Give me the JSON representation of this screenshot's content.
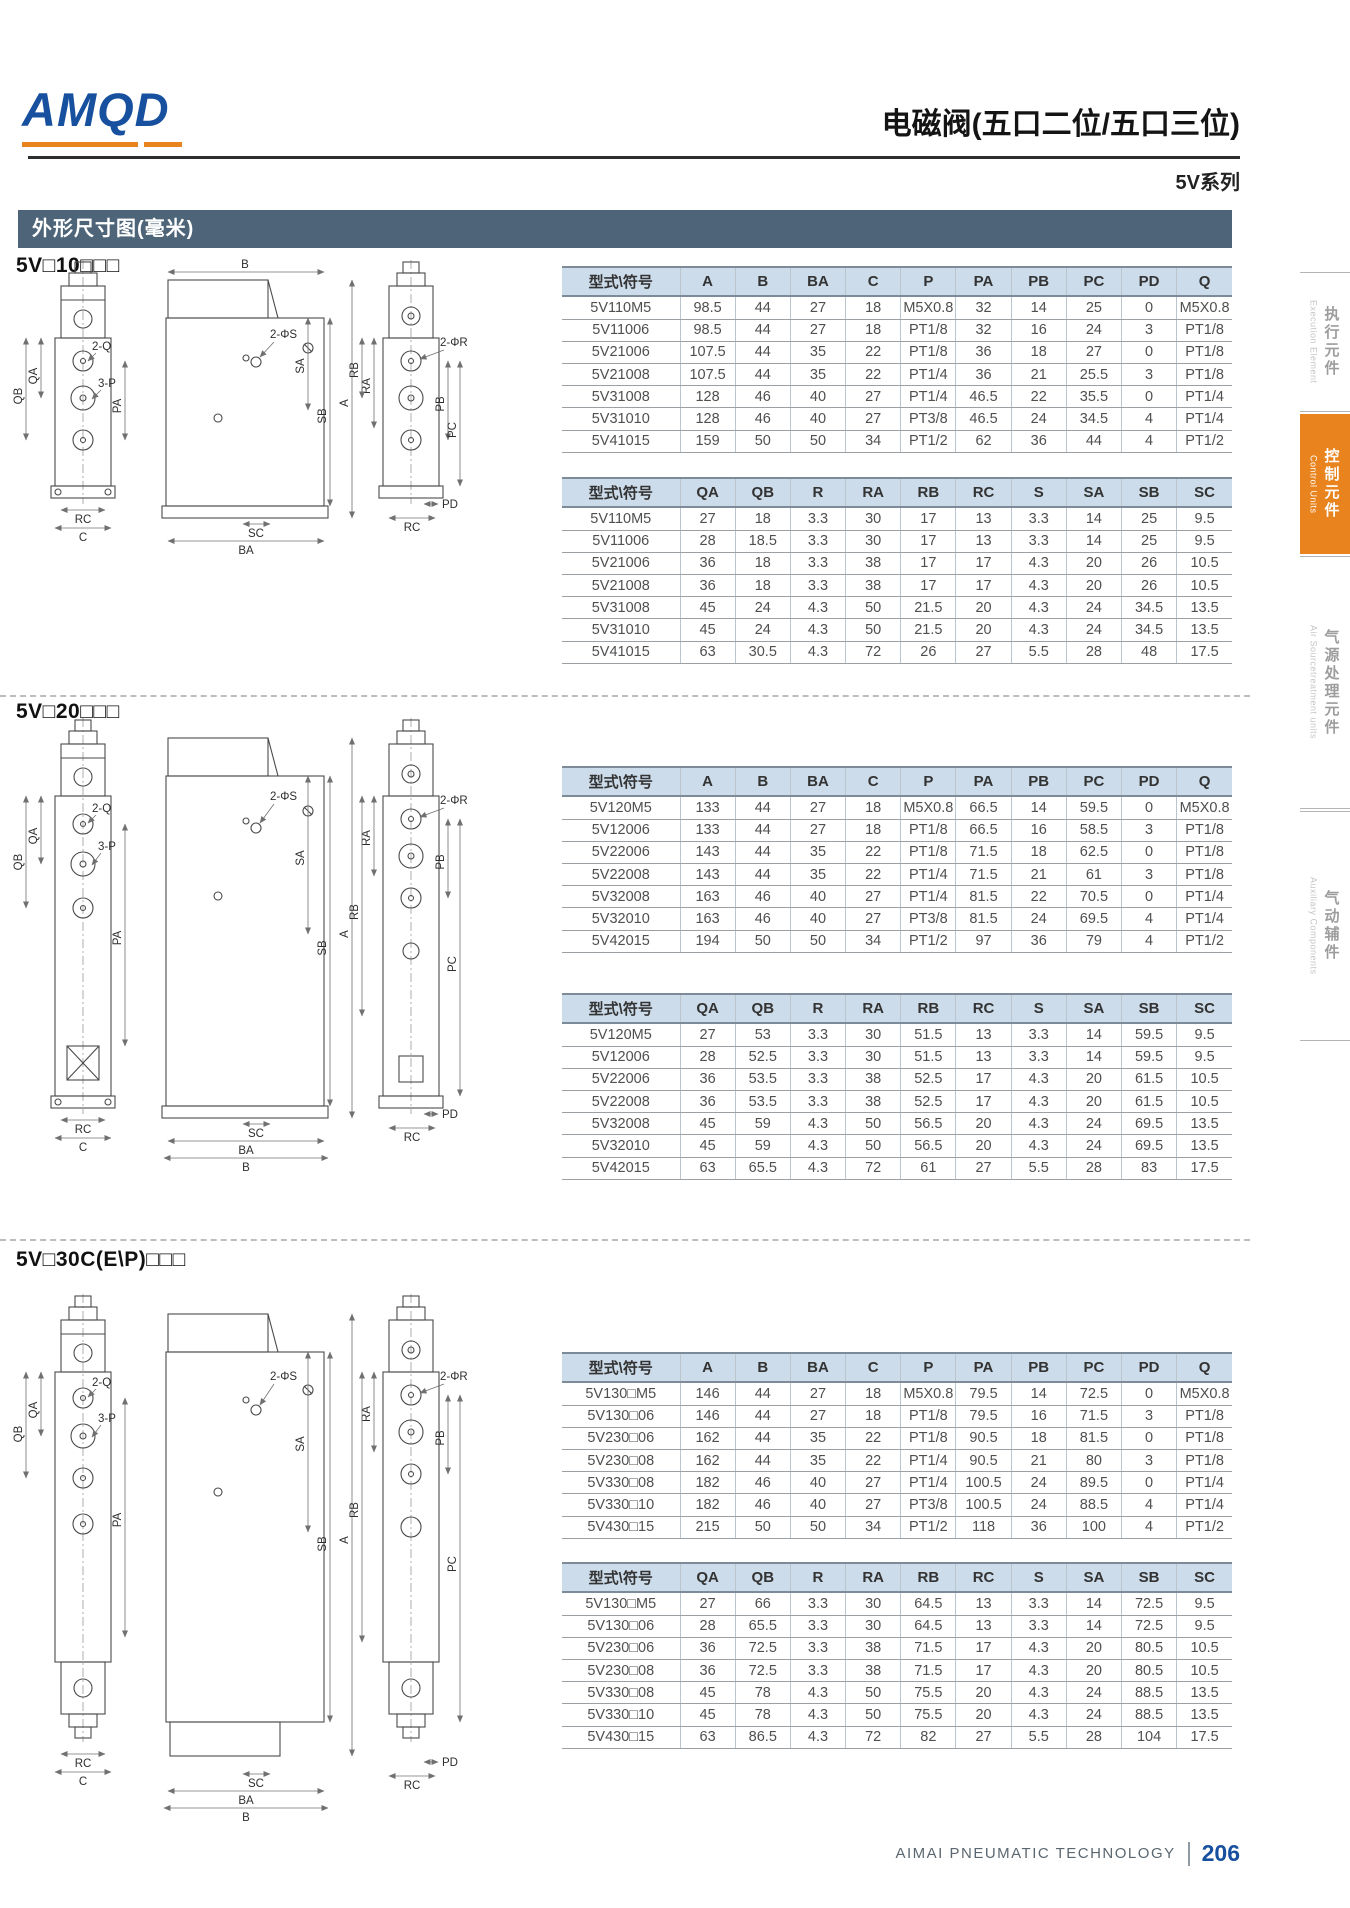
{
  "brand": {
    "logo": "AMQD",
    "title": "电磁阀(五口二位/五口三位)",
    "series": "5V系列"
  },
  "section_bar": "外形尺寸图(毫米)",
  "footer": {
    "company": "AIMAI PNEUMATIC TECHNOLOGY",
    "page": "206"
  },
  "sidebar": [
    {
      "cn": "执行元件",
      "en": "Execution Element"
    },
    {
      "cn": "控制元件",
      "en": "Control Units"
    },
    {
      "cn": "气源处理元件",
      "en": "Air Sourcetreatment units"
    },
    {
      "cn": "气动辅件",
      "en": "Auxiliary Components"
    }
  ],
  "accent_colors": {
    "brand_blue": "#17509e",
    "accent_orange": "#e8831d",
    "bar_slate": "#4e6579",
    "table_head": "#ccdcea"
  },
  "dims": {
    "a": "A",
    "b": "B",
    "ba": "BA",
    "c": "C",
    "q2": "2-Q",
    "p3": "3-P",
    "qa": "QA",
    "qb": "QB",
    "pa": "PA",
    "pb": "PB",
    "pc": "PC",
    "pd": "PD",
    "rc": "RC",
    "r2": "2-ΦR",
    "s2": "2-ΦS",
    "ra": "RA",
    "rb": "RB",
    "sa": "SA",
    "sb": "SB",
    "sc": "SC"
  },
  "table_headers": {
    "t1": [
      "型式\\符号",
      "A",
      "B",
      "BA",
      "C",
      "P",
      "PA",
      "PB",
      "PC",
      "PD",
      "Q"
    ],
    "t2": [
      "型式\\符号",
      "QA",
      "QB",
      "R",
      "RA",
      "RB",
      "RC",
      "S",
      "SA",
      "SB",
      "SC"
    ]
  },
  "sections": [
    {
      "label": "5V□10□□□",
      "main_rows": [
        [
          "5V110M5",
          "98.5",
          "44",
          "27",
          "18",
          "M5X0.8",
          "32",
          "14",
          "25",
          "0",
          "M5X0.8"
        ],
        [
          "5V11006",
          "98.5",
          "44",
          "27",
          "18",
          "PT1/8",
          "32",
          "16",
          "24",
          "3",
          "PT1/8"
        ],
        [
          "5V21006",
          "107.5",
          "44",
          "35",
          "22",
          "PT1/8",
          "36",
          "18",
          "27",
          "0",
          "PT1/8"
        ],
        [
          "5V21008",
          "107.5",
          "44",
          "35",
          "22",
          "PT1/4",
          "36",
          "21",
          "25.5",
          "3",
          "PT1/8"
        ],
        [
          "5V31008",
          "128",
          "46",
          "40",
          "27",
          "PT1/4",
          "46.5",
          "22",
          "35.5",
          "0",
          "PT1/4"
        ],
        [
          "5V31010",
          "128",
          "46",
          "40",
          "27",
          "PT3/8",
          "46.5",
          "24",
          "34.5",
          "4",
          "PT1/4"
        ],
        [
          "5V41015",
          "159",
          "50",
          "50",
          "34",
          "PT1/2",
          "62",
          "36",
          "44",
          "4",
          "PT1/2"
        ]
      ],
      "sub_rows": [
        [
          "5V110M5",
          "27",
          "18",
          "3.3",
          "30",
          "17",
          "13",
          "3.3",
          "14",
          "25",
          "9.5"
        ],
        [
          "5V11006",
          "28",
          "18.5",
          "3.3",
          "30",
          "17",
          "13",
          "3.3",
          "14",
          "25",
          "9.5"
        ],
        [
          "5V21006",
          "36",
          "18",
          "3.3",
          "38",
          "17",
          "17",
          "4.3",
          "20",
          "26",
          "10.5"
        ],
        [
          "5V21008",
          "36",
          "18",
          "3.3",
          "38",
          "17",
          "17",
          "4.3",
          "20",
          "26",
          "10.5"
        ],
        [
          "5V31008",
          "45",
          "24",
          "4.3",
          "50",
          "21.5",
          "20",
          "4.3",
          "24",
          "34.5",
          "13.5"
        ],
        [
          "5V31010",
          "45",
          "24",
          "4.3",
          "50",
          "21.5",
          "20",
          "4.3",
          "24",
          "34.5",
          "13.5"
        ],
        [
          "5V41015",
          "63",
          "30.5",
          "4.3",
          "72",
          "26",
          "27",
          "5.5",
          "28",
          "48",
          "17.5"
        ]
      ]
    },
    {
      "label": "5V□20□□□",
      "main_rows": [
        [
          "5V120M5",
          "133",
          "44",
          "27",
          "18",
          "M5X0.8",
          "66.5",
          "14",
          "59.5",
          "0",
          "M5X0.8"
        ],
        [
          "5V12006",
          "133",
          "44",
          "27",
          "18",
          "PT1/8",
          "66.5",
          "16",
          "58.5",
          "3",
          "PT1/8"
        ],
        [
          "5V22006",
          "143",
          "44",
          "35",
          "22",
          "PT1/8",
          "71.5",
          "18",
          "62.5",
          "0",
          "PT1/8"
        ],
        [
          "5V22008",
          "143",
          "44",
          "35",
          "22",
          "PT1/4",
          "71.5",
          "21",
          "61",
          "3",
          "PT1/8"
        ],
        [
          "5V32008",
          "163",
          "46",
          "40",
          "27",
          "PT1/4",
          "81.5",
          "22",
          "70.5",
          "0",
          "PT1/4"
        ],
        [
          "5V32010",
          "163",
          "46",
          "40",
          "27",
          "PT3/8",
          "81.5",
          "24",
          "69.5",
          "4",
          "PT1/4"
        ],
        [
          "5V42015",
          "194",
          "50",
          "50",
          "34",
          "PT1/2",
          "97",
          "36",
          "79",
          "4",
          "PT1/2"
        ]
      ],
      "sub_rows": [
        [
          "5V120M5",
          "27",
          "53",
          "3.3",
          "30",
          "51.5",
          "13",
          "3.3",
          "14",
          "59.5",
          "9.5"
        ],
        [
          "5V12006",
          "28",
          "52.5",
          "3.3",
          "30",
          "51.5",
          "13",
          "3.3",
          "14",
          "59.5",
          "9.5"
        ],
        [
          "5V22006",
          "36",
          "53.5",
          "3.3",
          "38",
          "52.5",
          "17",
          "4.3",
          "20",
          "61.5",
          "10.5"
        ],
        [
          "5V22008",
          "36",
          "53.5",
          "3.3",
          "38",
          "52.5",
          "17",
          "4.3",
          "20",
          "61.5",
          "10.5"
        ],
        [
          "5V32008",
          "45",
          "59",
          "4.3",
          "50",
          "56.5",
          "20",
          "4.3",
          "24",
          "69.5",
          "13.5"
        ],
        [
          "5V32010",
          "45",
          "59",
          "4.3",
          "50",
          "56.5",
          "20",
          "4.3",
          "24",
          "69.5",
          "13.5"
        ],
        [
          "5V42015",
          "63",
          "65.5",
          "4.3",
          "72",
          "61",
          "27",
          "5.5",
          "28",
          "83",
          "17.5"
        ]
      ]
    },
    {
      "label": "5V□30C(E\\P)□□□",
      "main_rows": [
        [
          "5V130□M5",
          "146",
          "44",
          "27",
          "18",
          "M5X0.8",
          "79.5",
          "14",
          "72.5",
          "0",
          "M5X0.8"
        ],
        [
          "5V130□06",
          "146",
          "44",
          "27",
          "18",
          "PT1/8",
          "79.5",
          "16",
          "71.5",
          "3",
          "PT1/8"
        ],
        [
          "5V230□06",
          "162",
          "44",
          "35",
          "22",
          "PT1/8",
          "90.5",
          "18",
          "81.5",
          "0",
          "PT1/8"
        ],
        [
          "5V230□08",
          "162",
          "44",
          "35",
          "22",
          "PT1/4",
          "90.5",
          "21",
          "80",
          "3",
          "PT1/8"
        ],
        [
          "5V330□08",
          "182",
          "46",
          "40",
          "27",
          "PT1/4",
          "100.5",
          "24",
          "89.5",
          "0",
          "PT1/4"
        ],
        [
          "5V330□10",
          "182",
          "46",
          "40",
          "27",
          "PT3/8",
          "100.5",
          "24",
          "88.5",
          "4",
          "PT1/4"
        ],
        [
          "5V430□15",
          "215",
          "50",
          "50",
          "34",
          "PT1/2",
          "118",
          "36",
          "100",
          "4",
          "PT1/2"
        ]
      ],
      "sub_rows": [
        [
          "5V130□M5",
          "27",
          "66",
          "3.3",
          "30",
          "64.5",
          "13",
          "3.3",
          "14",
          "72.5",
          "9.5"
        ],
        [
          "5V130□06",
          "28",
          "65.5",
          "3.3",
          "30",
          "64.5",
          "13",
          "3.3",
          "14",
          "72.5",
          "9.5"
        ],
        [
          "5V230□06",
          "36",
          "72.5",
          "3.3",
          "38",
          "71.5",
          "17",
          "4.3",
          "20",
          "80.5",
          "10.5"
        ],
        [
          "5V230□08",
          "36",
          "72.5",
          "3.3",
          "38",
          "71.5",
          "17",
          "4.3",
          "20",
          "80.5",
          "10.5"
        ],
        [
          "5V330□08",
          "45",
          "78",
          "4.3",
          "50",
          "75.5",
          "20",
          "4.3",
          "24",
          "88.5",
          "13.5"
        ],
        [
          "5V330□10",
          "45",
          "78",
          "4.3",
          "50",
          "75.5",
          "20",
          "4.3",
          "24",
          "88.5",
          "13.5"
        ],
        [
          "5V430□15",
          "63",
          "86.5",
          "4.3",
          "72",
          "82",
          "27",
          "5.5",
          "28",
          "104",
          "17.5"
        ]
      ]
    }
  ]
}
